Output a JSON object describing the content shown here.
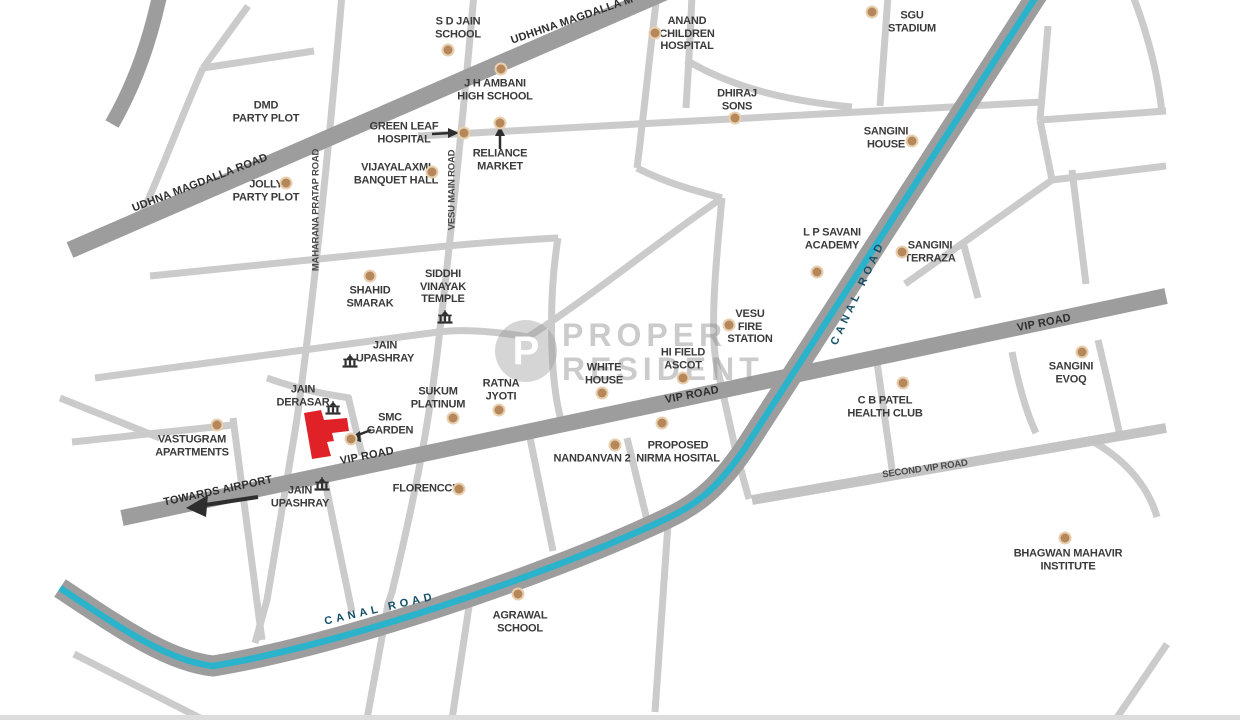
{
  "map": {
    "type": "location-map",
    "colors": {
      "background": "#ffffff",
      "major_road": "#9d9d9d",
      "minor_road": "#cbcbcb",
      "second_vip_road": "#c4c4c4",
      "canal_water": "#2cb3cc",
      "canal_label_text": "#155068",
      "label_text": "#3a3a3a",
      "marker_dot": "#b5875a",
      "property_highlight": "#e02127",
      "watermark_gray": "#c7c7c7"
    },
    "watermark": {
      "logo_letter": "P",
      "line1": "PROPER",
      "line2": "RESIDENT"
    },
    "road_labels": [
      {
        "text": "UDHNA MAGDALLA ROAD",
        "x": 200,
        "y": 183,
        "rot": -21,
        "style": "on-road"
      },
      {
        "text": "UDHHNA MAGDALLA M",
        "x": 572,
        "y": 20,
        "rot": -19,
        "style": "on-road"
      },
      {
        "text": "MAHARANA PRATAP ROAD",
        "x": 316,
        "y": 210,
        "rot": -90,
        "style": "side-road"
      },
      {
        "text": "VESU MAIN ROAD",
        "x": 452,
        "y": 190,
        "rot": -90,
        "style": "side-road"
      },
      {
        "text": "VIP ROAD",
        "x": 367,
        "y": 456,
        "rot": -11,
        "style": "on-road"
      },
      {
        "text": "VIP ROAD",
        "x": 692,
        "y": 395,
        "rot": -11,
        "style": "on-road"
      },
      {
        "text": "VIP ROAD",
        "x": 1044,
        "y": 323,
        "rot": -11,
        "style": "on-road"
      },
      {
        "text": "TOWARDS AIRPORT",
        "x": 218,
        "y": 491,
        "rot": -12,
        "style": "on-road"
      },
      {
        "text": "SECOND VIP ROAD",
        "x": 925,
        "y": 469,
        "rot": -8,
        "style": "side-road"
      },
      {
        "text": "CANAL ROAD",
        "x": 858,
        "y": 293,
        "rot": -65,
        "style": "canal"
      },
      {
        "text": "CANAL ROAD",
        "x": 380,
        "y": 609,
        "rot": -13,
        "style": "canal"
      }
    ],
    "places": [
      {
        "label": "S D JAIN\nSCHOOL",
        "x": 458,
        "y": 28,
        "marker": "dot",
        "mx": 448,
        "my": 50
      },
      {
        "label": "DMD\nPARTY PLOT",
        "x": 266,
        "y": 112,
        "marker": "none"
      },
      {
        "label": "J H AMBANI\nHIGH SCHOOL",
        "x": 495,
        "y": 90,
        "marker": "dot",
        "mx": 501,
        "my": 69
      },
      {
        "label": "ANAND\nCHILDREN\nHOSPITAL",
        "x": 687,
        "y": 34,
        "marker": "dot",
        "mx": 655,
        "my": 33
      },
      {
        "label": "DHIRAJ\nSONS",
        "x": 737,
        "y": 100,
        "marker": "dot",
        "mx": 735,
        "my": 118
      },
      {
        "label": "SGU\nSTADIUM",
        "x": 912,
        "y": 22,
        "marker": "dot",
        "mx": 872,
        "my": 12
      },
      {
        "label": "GREEN LEAF\nHOSPITAL",
        "x": 404,
        "y": 133,
        "marker": "dot",
        "mx": 464,
        "my": 133
      },
      {
        "label": "RELIANCE\nMARKET",
        "x": 500,
        "y": 160,
        "marker": "dot",
        "mx": 500,
        "my": 123
      },
      {
        "label": "VIJAYALAXMI\nBANQUET HALL",
        "x": 396,
        "y": 174,
        "marker": "dot",
        "mx": 432,
        "my": 172
      },
      {
        "label": "JOLLY\nPARTY PLOT",
        "x": 266,
        "y": 191,
        "marker": "dot",
        "mx": 286,
        "my": 183
      },
      {
        "label": "L P SAVANI\nACADEMY",
        "x": 832,
        "y": 239,
        "marker": "dot",
        "mx": 817,
        "my": 272
      },
      {
        "label": "SANGINI\nHOUSE",
        "x": 886,
        "y": 138,
        "marker": "dot",
        "mx": 912,
        "my": 141
      },
      {
        "label": "SANGINI\nTERRAZA",
        "x": 930,
        "y": 252,
        "marker": "dot",
        "mx": 902,
        "my": 252
      },
      {
        "label": "SHAHID\nSMARAK",
        "x": 370,
        "y": 297,
        "marker": "dot",
        "mx": 370,
        "my": 276
      },
      {
        "label": "SIDDHI\nVINAYAK\nTEMPLE",
        "x": 443,
        "y": 287,
        "marker": "temple",
        "mx": 445,
        "my": 317
      },
      {
        "label": "JAIN\nUPASHRAY",
        "x": 385,
        "y": 352,
        "marker": "temple",
        "mx": 350,
        "my": 361
      },
      {
        "label": "VESU\nFIRE\nSTATION",
        "x": 750,
        "y": 327,
        "marker": "dot",
        "mx": 729,
        "my": 325
      },
      {
        "label": "HI FIELD\nASCOT",
        "x": 683,
        "y": 359,
        "marker": "dot",
        "mx": 683,
        "my": 378
      },
      {
        "label": "WHITE\nHOUSE",
        "x": 604,
        "y": 374,
        "marker": "dot",
        "mx": 602,
        "my": 393
      },
      {
        "label": "SANGINI\nEVOQ",
        "x": 1071,
        "y": 373,
        "marker": "dot",
        "mx": 1082,
        "my": 352
      },
      {
        "label": "RATNA\nJYOTI",
        "x": 501,
        "y": 390,
        "marker": "dot",
        "mx": 499,
        "my": 410
      },
      {
        "label": "SUKUM\nPLATINUM",
        "x": 438,
        "y": 398,
        "marker": "dot",
        "mx": 453,
        "my": 418
      },
      {
        "label": "JAIN\nDERASAR",
        "x": 303,
        "y": 396,
        "marker": "temple",
        "mx": 333,
        "my": 408
      },
      {
        "label": "SMC\nGARDEN",
        "x": 390,
        "y": 424,
        "marker": "dot",
        "mx": 351,
        "my": 439
      },
      {
        "label": "C B PATEL\nHEALTH CLUB",
        "x": 885,
        "y": 407,
        "marker": "dot",
        "mx": 903,
        "my": 383
      },
      {
        "label": "VASTUGRAM\nAPARTMENTS",
        "x": 192,
        "y": 446,
        "marker": "dot",
        "mx": 217,
        "my": 425
      },
      {
        "label": "NANDANVAN 2",
        "x": 592,
        "y": 459,
        "marker": "dot",
        "mx": 615,
        "my": 445
      },
      {
        "label": "PROPOSED\nNIRMA HOSITAL",
        "x": 678,
        "y": 452,
        "marker": "dot",
        "mx": 662,
        "my": 423
      },
      {
        "label": "JAIN\nUPASHRAY",
        "x": 300,
        "y": 497,
        "marker": "temple",
        "mx": 322,
        "my": 484
      },
      {
        "label": "FLORENCCE",
        "x": 426,
        "y": 489,
        "marker": "dot",
        "mx": 459,
        "my": 489
      },
      {
        "label": "AGRAWAL\nSCHOOL",
        "x": 520,
        "y": 622,
        "marker": "dot",
        "mx": 518,
        "my": 594
      },
      {
        "label": "BHAGWAN MAHAVIR\nINSTITUTE",
        "x": 1068,
        "y": 560,
        "marker": "dot",
        "mx": 1065,
        "my": 538
      }
    ]
  }
}
